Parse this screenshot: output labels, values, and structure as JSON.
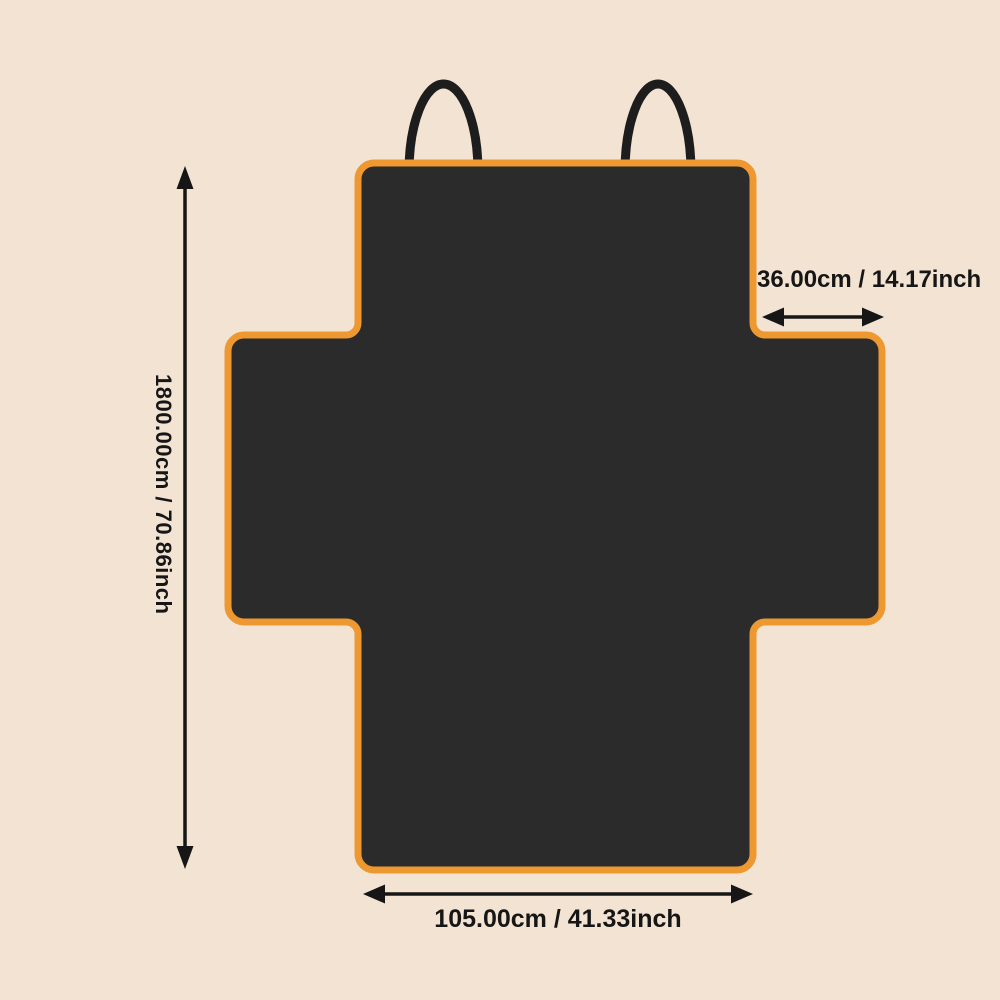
{
  "diagram": {
    "kind": "product-dimension-diagram",
    "colors": {
      "background": "#f2e3d2",
      "body": "#2b2b2b",
      "trim": "#ee9831",
      "strap": "#1d1d1d",
      "annotation": "#161616"
    },
    "dimensions": {
      "height_label": "1800.00cm / 70.86inch",
      "flap_width_label": "36.00cm / 14.17inch",
      "bottom_width_label": "105.00cm / 41.33inch"
    }
  }
}
